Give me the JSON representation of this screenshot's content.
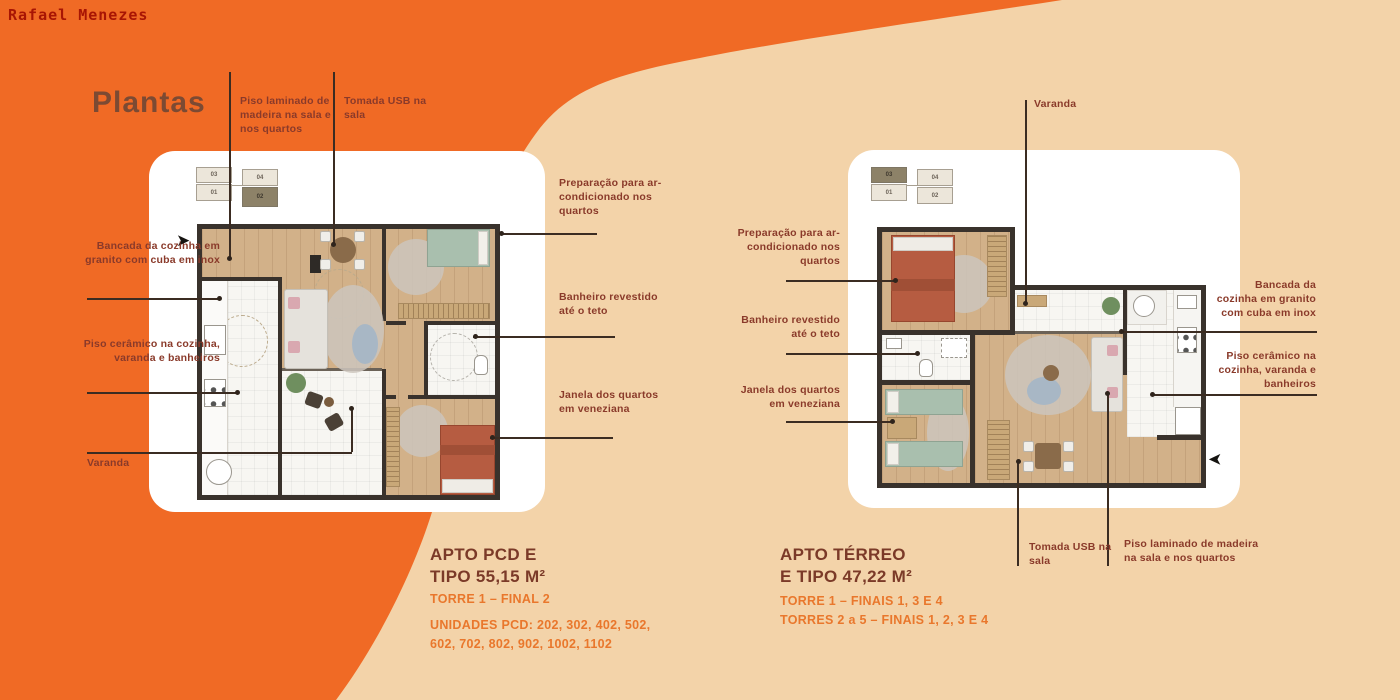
{
  "page": {
    "credit": "Rafael Menezes",
    "title": "Plantas"
  },
  "colors": {
    "background_orange": "#f06a25",
    "background_peach": "#f3d3a9",
    "card_white": "#ffffff",
    "heading_brown": "#7b3a28",
    "caption_orange": "#e9772c",
    "annotation_rust": "#8a3a2a",
    "title_brown": "#7c4a33",
    "credit_red": "#a81504",
    "wall_dark": "#39322c",
    "unit_highlight": "#8d8268"
  },
  "left_plan": {
    "key": {
      "units": [
        "03",
        "04",
        "01",
        "02"
      ],
      "highlighted": "02"
    },
    "annotations": {
      "piso_laminado": "Piso laminado de madeira na sala e nos quartos",
      "tomada_usb": "Tomada USB na sala",
      "preparacao": "Preparação para ar-condicionado nos quartos",
      "banheiro": "Banheiro revestido até o teto",
      "janela": "Janela dos quartos em veneziana",
      "bancada": "Bancada da cozinha em granito com cuba em inox",
      "piso_ceramico": "Piso cerâmico na cozinha, varanda e banheiros",
      "varanda": "Varanda"
    },
    "caption": {
      "title_line1": "APTO PCD E",
      "title_line2": "TIPO 55,15 M²",
      "torre": "TORRE 1 – FINAL 2",
      "unidades": "UNIDADES PCD: 202, 302, 402, 502, 602, 702, 802, 902, 1002, 1102"
    }
  },
  "right_plan": {
    "key": {
      "units": [
        "03",
        "04",
        "01",
        "02"
      ],
      "highlighted": "03"
    },
    "annotations": {
      "varanda": "Varanda",
      "preparacao": "Preparação para ar-condicionado nos quartos",
      "banheiro": "Banheiro revestido até o teto",
      "janela": "Janela dos quartos em veneziana",
      "bancada": "Bancada da cozinha em granito com cuba em inox",
      "piso_ceramico": "Piso cerâmico na cozinha, varanda e banheiros",
      "tomada_usb": "Tomada USB na sala",
      "piso_laminado": "Piso laminado de madeira na sala e nos quartos"
    },
    "caption": {
      "title_line1": "APTO TÉRREO",
      "title_line2": "E TIPO 47,22 M²",
      "torre_1": "TORRE 1 – FINAIS 1, 3 E 4",
      "torre_2": "TORRES 2 a 5 – FINAIS 1, 2, 3 E 4"
    }
  }
}
